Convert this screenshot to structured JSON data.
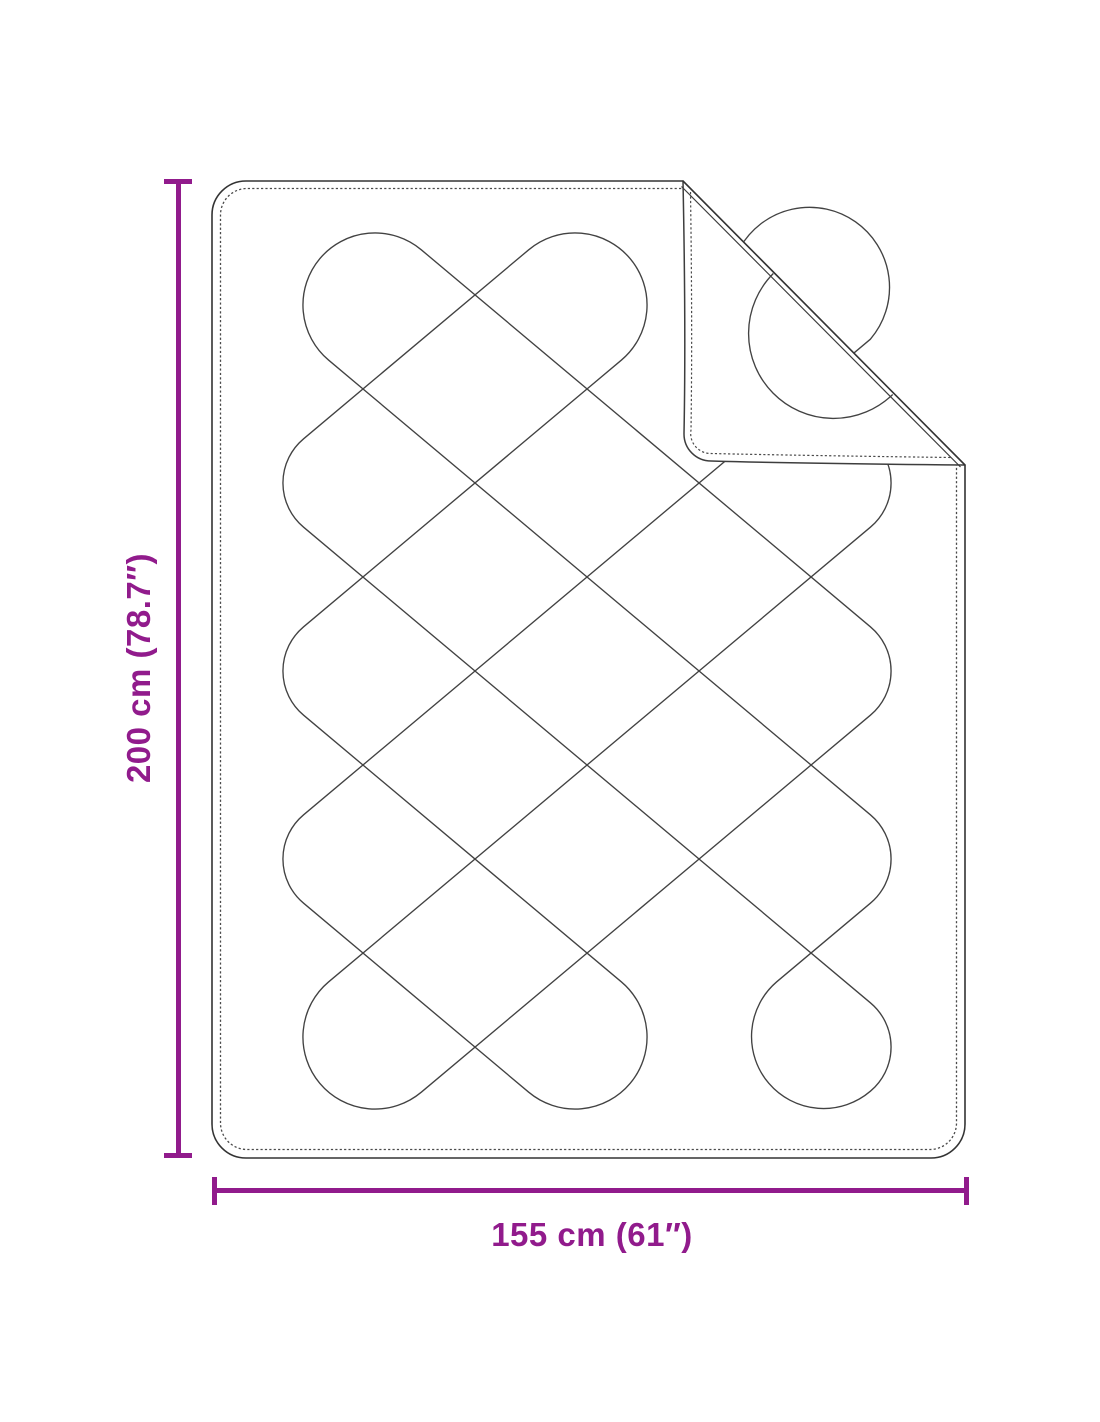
{
  "diagram": {
    "subject": "quilted-blanket-with-folded-corner",
    "line_color": "#3d3d3d",
    "accent_color": "#911b8c",
    "dimensions": {
      "height_label": "200 cm (78.7″)",
      "width_label": "155 cm (61″)"
    }
  }
}
